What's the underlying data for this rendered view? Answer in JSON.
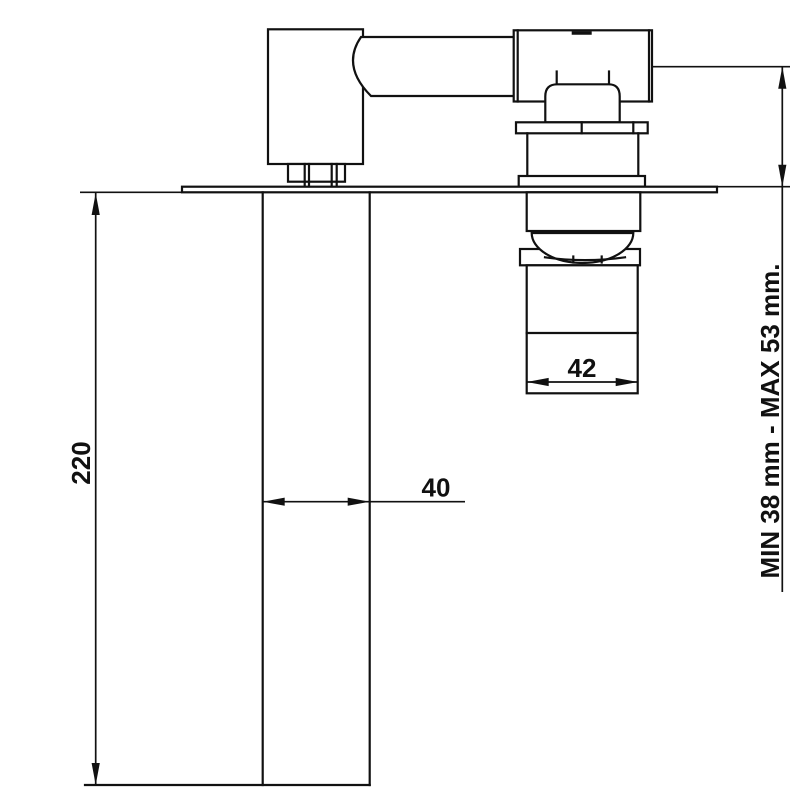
{
  "drawing": {
    "background_color": "#ffffff",
    "line_color": "#111111",
    "labels": {
      "projection": "220",
      "spout_width": "40",
      "escutcheon_width": "42",
      "wall_depth": "MIN 38 mm - MAX 53 mm."
    },
    "values_mm": {
      "projection": 220,
      "spout_width": 40,
      "escutcheon_width": 42,
      "wall_depth_min": 38,
      "wall_depth_max": 53
    }
  }
}
